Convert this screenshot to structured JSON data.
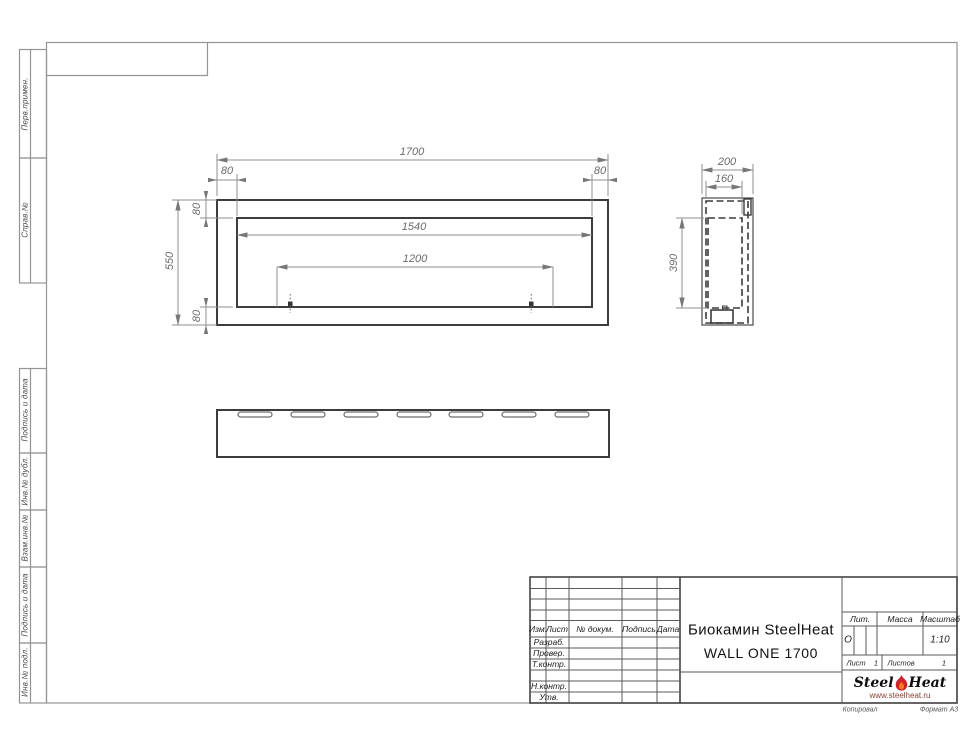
{
  "sheet": {
    "margin_labels_top": [
      "Перв.примен.",
      "Справ.№"
    ],
    "margin_labels_bottom": [
      "Подпись и дата",
      "Инв.№ дубл.",
      "Взам.инв.№",
      "Подпись и дата",
      "Инв.№ подл."
    ],
    "footer": {
      "copied": "Копировал",
      "format": "Формат А3"
    }
  },
  "drawing": {
    "front_view": {
      "dims": {
        "width_total": "1700",
        "offset_left": "80",
        "offset_right": "80",
        "height_total": "550",
        "inset_top": "80",
        "inset_bottom": "80",
        "opening_width": "1540",
        "burner_span": "1200"
      }
    },
    "side_view": {
      "dims": {
        "depth_total": "200",
        "depth_inner": "160",
        "height_inner": "390"
      }
    }
  },
  "title_block": {
    "header_cols": [
      "Изм.",
      "Лист",
      "№ докум.",
      "Подпись",
      "Дата"
    ],
    "rows": [
      "Разраб.",
      "Провер.",
      "Т.контр.",
      "Н.контр.",
      "Утв."
    ],
    "title_line1": "Биокамин SteelHeat",
    "title_line2": "WALL ONE 1700",
    "lit_label": "Лит.",
    "lit_value": "О",
    "mass_label": "Масса",
    "scale_label": "Масштаб",
    "scale_value": "1:10",
    "sheet_label": "Лист",
    "sheet_value": "1",
    "sheets_label": "Листов",
    "sheets_value": "1"
  },
  "logo": {
    "part1": "Steel",
    "part2": "Heat",
    "url": "www.steelheat.ru",
    "flame_red": "#d2232a",
    "flame_orange": "#f47b20"
  }
}
